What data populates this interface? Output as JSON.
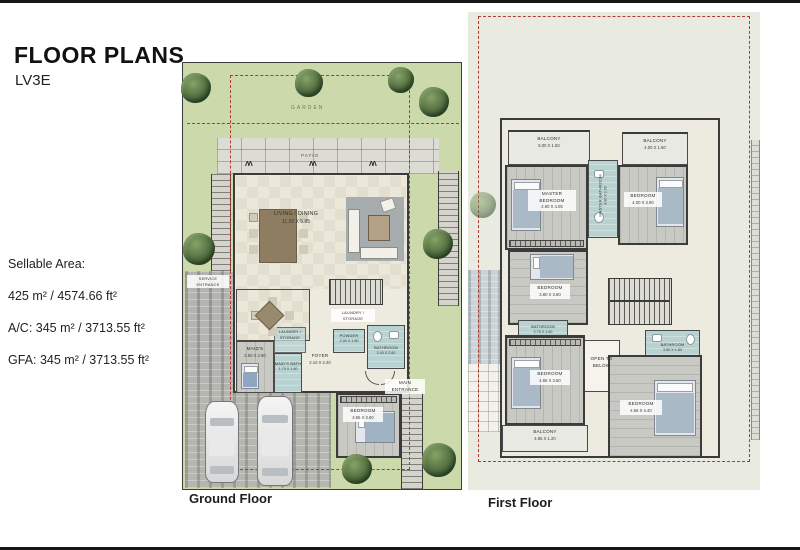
{
  "header": {
    "title": "FLOOR PLANS",
    "subtitle": "LV3E"
  },
  "area_info": {
    "heading": "Sellable Area:",
    "sellable": "425 m² / 4574.66 ft²",
    "ac": "A/C: 345 m² / 3713.55 ft²",
    "gfa": "GFA: 345 m² / 3713.55 ft²"
  },
  "ground_floor": {
    "caption": "Ground Floor",
    "garden_label": "GARDEN",
    "patio_label": "PATIO",
    "rooms": {
      "living_dining": {
        "name": "LIVING / DINING",
        "dims": "11.50 X 5.85"
      },
      "service_entrance": {
        "name": "SERVICE ENTRANCE"
      },
      "maids": {
        "name": "MAID'S",
        "dims": "2.50 X 2.90"
      },
      "maids_bath": {
        "name": "MAID'S BATH",
        "dims": "1.70 X 1.60"
      },
      "laundry_storage_a": {
        "name": "LAUNDRY / STORAGE"
      },
      "laundry_storage_b": {
        "name": "LAUNDRY / STORAGE"
      },
      "powder": {
        "name": "POWDER",
        "dims": "2.30 X 1.50"
      },
      "foyer": {
        "name": "FOYER",
        "dims": "2.10 X 2.40"
      },
      "bathroom": {
        "name": "BATHROOM",
        "dims": "2.40 X 2.60"
      },
      "bedroom": {
        "name": "BEDROOM",
        "dims": "4.55 X 3.60"
      },
      "main_entrance": {
        "name": "MAIN ENTRANCE"
      }
    }
  },
  "first_floor": {
    "caption": "First Floor",
    "rooms": {
      "balcony_top_left": {
        "name": "BALCONY",
        "dims": "5.00 X 1.50"
      },
      "balcony_top_right": {
        "name": "BALCONY",
        "dims": "4.00 X 1.50"
      },
      "master_bedroom": {
        "name": "MASTER BEDROOM",
        "dims": "4.90 X 4.05"
      },
      "bedroom_top_right": {
        "name": "BEDROOM",
        "dims": "4.00 X 3.90"
      },
      "master_bathroom": {
        "name": "MASTER BATHROOM",
        "dims": "3.90 X 1.50"
      },
      "bedroom_mid_left": {
        "name": "BEDROOM",
        "dims": "3.80 X 3.60"
      },
      "bathroom_left": {
        "name": "BATHROOM",
        "dims": "2.75 X 1.60"
      },
      "bathroom_right": {
        "name": "BATHROOM",
        "dims": "3.50 X 1.80"
      },
      "open_to_below": {
        "name": "OPEN TO BELOW"
      },
      "bedroom_bottom_left": {
        "name": "BEDROOM",
        "dims": "4.65 X 3.60"
      },
      "bedroom_bottom_right": {
        "name": "BEDROOM",
        "dims": "4.55 X 4.40"
      },
      "balcony_bottom": {
        "name": "BALCONY",
        "dims": "4.85 X 1.20"
      }
    }
  },
  "colors": {
    "boundary_red": "#b2392c",
    "garden_green": "#ccd9aa",
    "bath_teal": "#b7d2d0",
    "wall_dark": "#3b3b3b"
  }
}
